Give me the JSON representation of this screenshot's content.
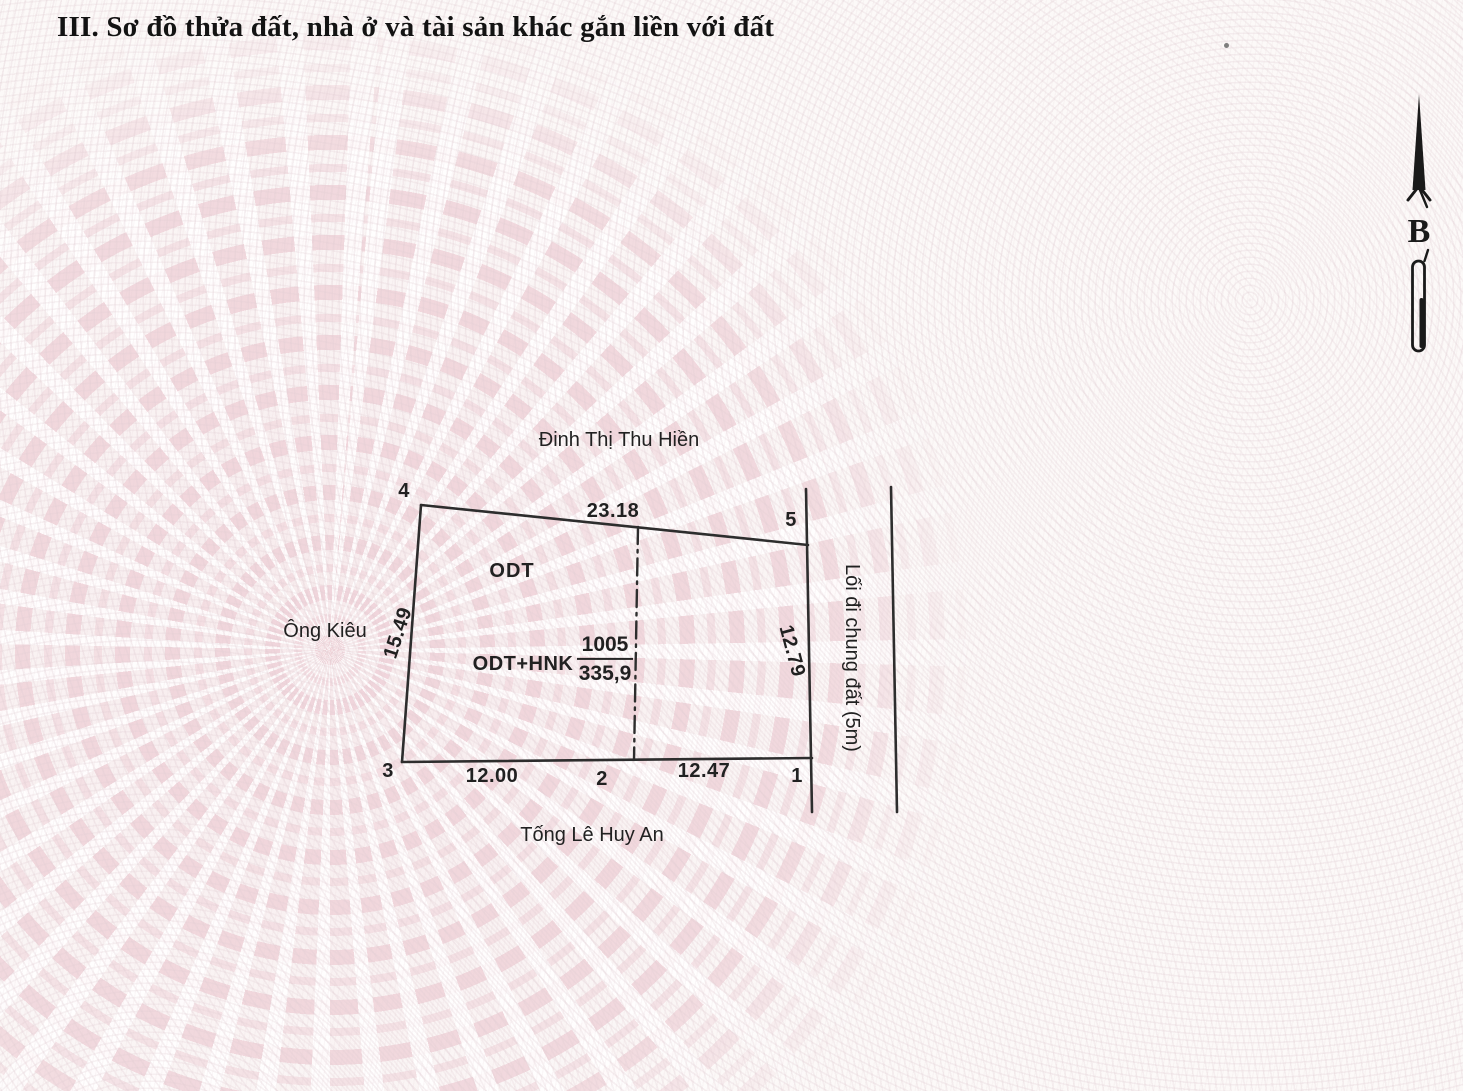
{
  "title": "III. Sơ đồ thửa đất, nhà ở và tài sản khác gắn liền với đất",
  "compass": {
    "north_label": "B"
  },
  "parcel": {
    "number": "1005",
    "area": "335,9",
    "land_use_zone_top": "ODT",
    "land_use_zone_bottom": "ODT+HNK"
  },
  "vertex_labels": {
    "v1": "1",
    "v2": "2",
    "v3": "3",
    "v4": "4",
    "v5": "5"
  },
  "measurements": {
    "top": "23.18",
    "left": "15.49",
    "right": "12.79",
    "bottom_left": "12.00",
    "bottom_right": "12.47"
  },
  "adjacent": {
    "north": "Đinh Thị Thu Hiền",
    "west": "Ông Kiêu",
    "south": "Tống Lê Huy An",
    "east": "Lối đi chung đất (5m)"
  },
  "colors": {
    "line": "#2d2d2d",
    "text": "#212121",
    "background": "#fcf9f8",
    "pattern_pink": "#eecfd6"
  }
}
